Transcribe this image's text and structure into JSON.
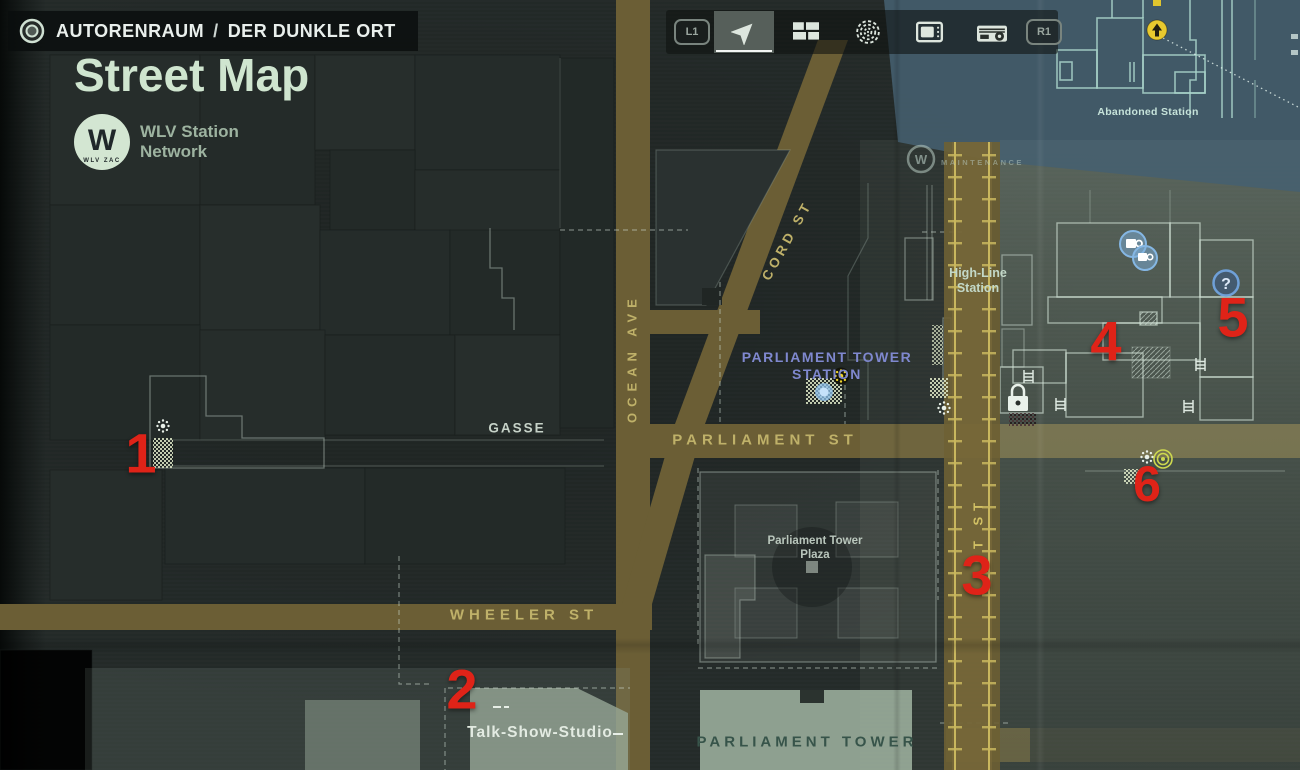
{
  "header": {
    "area": "AUTORENRAUM",
    "separator": "/",
    "location": "DER DUNKLE ORT"
  },
  "title": "Street Map",
  "network_logo": {
    "monogram": "W",
    "ring_text": "WLV ZAC",
    "label_line1": "WLV Station",
    "label_line2": "Network"
  },
  "toolbar": {
    "left_bumper": "L1",
    "right_bumper": "R1",
    "tabs": [
      {
        "name": "map",
        "selected": true
      },
      {
        "name": "case-board",
        "selected": false
      },
      {
        "name": "echoes-spiral",
        "selected": false
      },
      {
        "name": "tv",
        "selected": false
      },
      {
        "name": "radio",
        "selected": false
      }
    ]
  },
  "streets": {
    "ocean": "OCEAN AVE",
    "cord": "CORD ST",
    "parliament": "PARLIAMENT ST",
    "wheeler": "WHEELER ST",
    "ft": "FT ST"
  },
  "places": {
    "gasse": "GASSE",
    "highline_line1": "High-Line",
    "highline_line2": "Station",
    "pt_station_line1": "PARLIAMENT TOWER",
    "pt_station_line2": "STATION",
    "plaza_line1": "Parliament Tower",
    "plaza_line2": "Plaza",
    "tower": "PARLIAMENT TOWER",
    "studio": "Talk-Show-Studio",
    "abandoned_station": "Abandoned Station",
    "maintenance": "MAINTENANCE",
    "maintenance_logo": "W"
  },
  "markers": [
    {
      "label": "1"
    },
    {
      "label": "2"
    },
    {
      "label": "3"
    },
    {
      "label": "4"
    },
    {
      "label": "5"
    },
    {
      "label": "6"
    }
  ],
  "map_icons": {
    "question_mark": "?"
  },
  "colors": {
    "marker_red": "#df2318",
    "street_gold": "#bfb169",
    "station_blue": "#7f88cf",
    "safe_light_yellow": "#edd22b",
    "road_tan": "#6b5e35",
    "overlay_blue": "#46606f",
    "room_line": "#d7e8dc"
  }
}
